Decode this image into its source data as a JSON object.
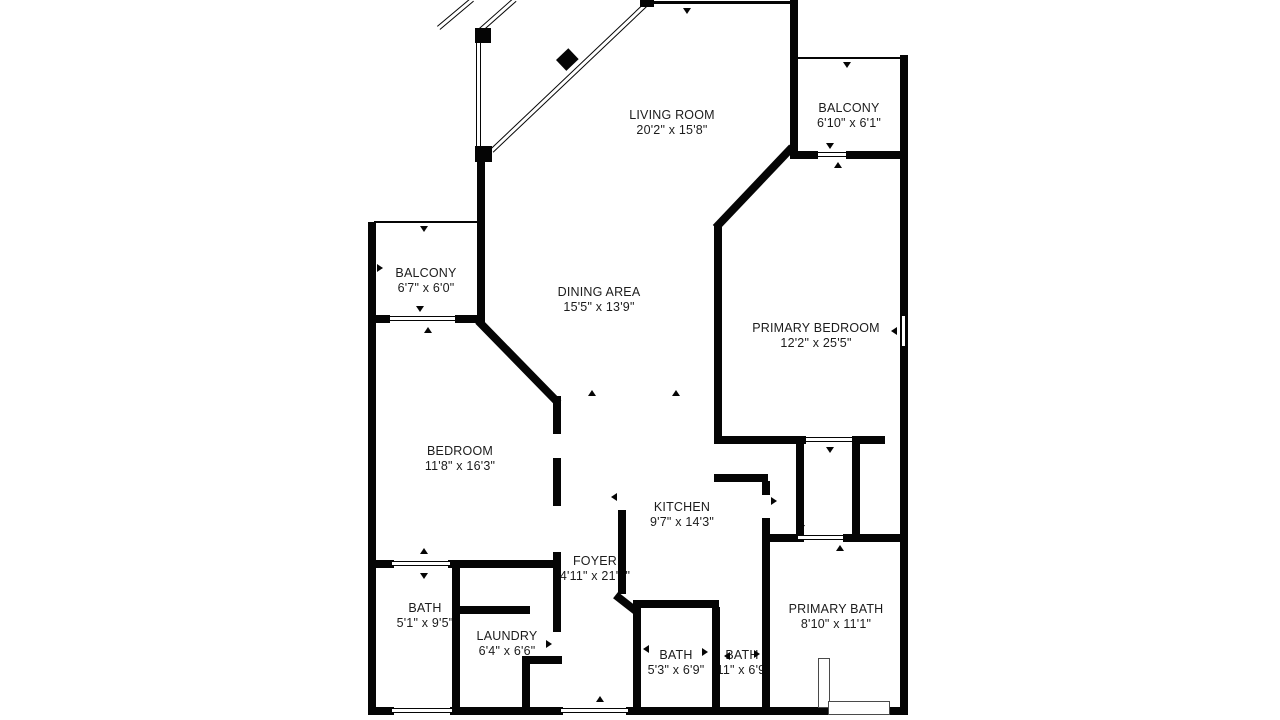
{
  "figure": {
    "kind": "floor-plan",
    "background": "#ffffff",
    "wall_color": "#050505",
    "text_color": "#1c1c1c"
  },
  "rooms": [
    {
      "name": "LIVING ROOM",
      "dims": "20'2\" x 15'8\""
    },
    {
      "name": "BALCONY",
      "dims": "6'10\" x 6'1\""
    },
    {
      "name": "BALCONY",
      "dims": "6'7\" x 6'0\""
    },
    {
      "name": "DINING AREA",
      "dims": "15'5\" x 13'9\""
    },
    {
      "name": "PRIMARY BEDROOM",
      "dims": "12'2\" x 25'5\""
    },
    {
      "name": "BEDROOM",
      "dims": "11'8\" x 16'3\""
    },
    {
      "name": "KITCHEN",
      "dims": "9'7\" x 14'3\""
    },
    {
      "name": "FOYER",
      "dims": "4'11\" x 21'3\""
    },
    {
      "name": "BATH",
      "dims": "5'1\" x 9'5\""
    },
    {
      "name": "LAUNDRY",
      "dims": "6'4\" x 6'6\""
    },
    {
      "name": "BATH",
      "dims": "5'3\" x 6'9\""
    },
    {
      "name": "BATH",
      "dims": "'11\" x 6'9\""
    },
    {
      "name": "PRIMARY BATH",
      "dims": "8'10\" x 11'1\""
    }
  ]
}
